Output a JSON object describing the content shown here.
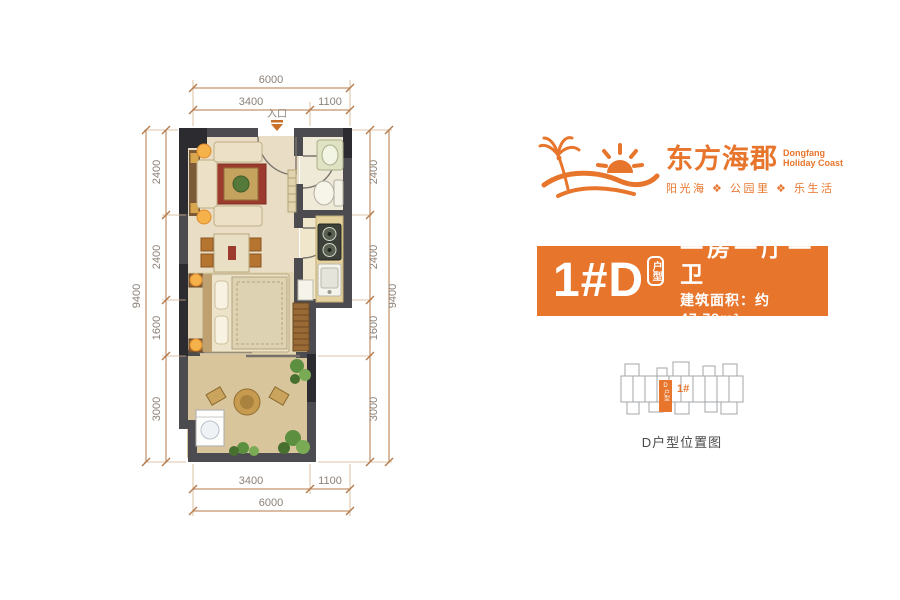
{
  "logo": {
    "name_cn": "东方海郡",
    "name_en_line1": "Dongfang",
    "name_en_line2": "Holiday Coast",
    "tagline": "阳光海 ❖ 公园里 ❖ 乐生活",
    "color": "#E8752C"
  },
  "badge": {
    "unit_code": "1#D",
    "unit_tag": "户型",
    "layout_summary": "一房一厅一卫",
    "area_text": "建筑面积：约47.73m²",
    "bg_color": "#E8752C"
  },
  "floorplan": {
    "entrance_label": "入口",
    "dims": {
      "top_total": "6000",
      "top_seg_1": "3400",
      "top_seg_2": "1100",
      "bottom_seg_1": "3400",
      "bottom_seg_2": "1100",
      "bottom_total": "6000",
      "left_total": "9400",
      "left_seg_1": "2400",
      "left_seg_2": "2400",
      "left_seg_3": "1600",
      "left_seg_4": "3000",
      "right_total": "9400",
      "right_seg_1": "2400",
      "right_seg_2": "2400",
      "right_seg_3": "1600",
      "right_seg_4": "3000"
    }
  },
  "location_map": {
    "building_label": "1#",
    "unit_label": "D户型",
    "caption": "D户型位置图"
  }
}
